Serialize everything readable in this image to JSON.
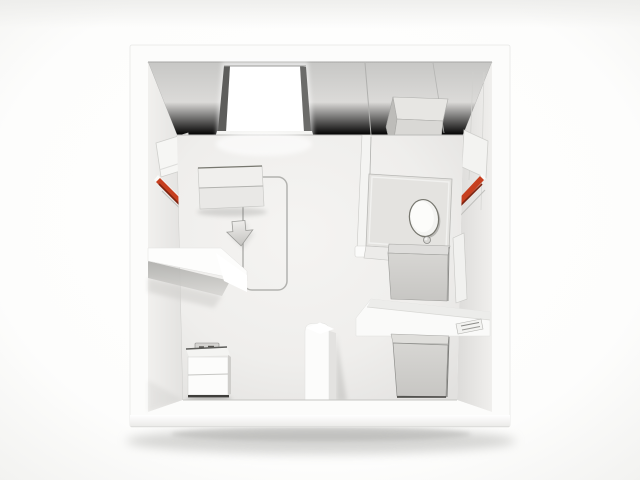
{
  "scene": {
    "type": "3d-architectural-render",
    "view": "top-down cutaway (dollhouse view)",
    "subject": "compact white studio apartment unit with bathroom partition",
    "background_color": "#ffffff"
  },
  "palette": {
    "background": "#ffffff",
    "frame_white": "#fcfcfb",
    "back_wall_top": "#c9c9c7",
    "back_wall_bottom": "#ecebe9",
    "side_wall": "#e7e6e4",
    "floor_light": "#f4f3f1",
    "floor_dark": "#e4e3e1",
    "furniture_white": "#f7f7f5",
    "furniture_gray": "#d2d1ce",
    "window_frame_dark": "#5d5d5b",
    "window_glow": "#ffffff",
    "accent_red": "#c63f1f",
    "accent_red_bright": "#e0582e",
    "accent_red_dark": "#7d2310",
    "outline_gray": "#b2b2af",
    "base_dark": "#3f3e3b",
    "shadow_gray": "#9a9a97"
  },
  "objects": [
    {
      "name": "apartment-shell",
      "label": "white cube shell with thick walls"
    },
    {
      "name": "back-wall",
      "label": "rear wall band with panel seams"
    },
    {
      "name": "window",
      "label": "bright glowing window with dark side frames"
    },
    {
      "name": "upper-cabinet",
      "label": "wall-mounted cabinet box, top right"
    },
    {
      "name": "left-wall-panel",
      "label": "fold-down panel on left wall"
    },
    {
      "name": "left-accent-stripe",
      "label": "diagonal red accent stripe, left wall"
    },
    {
      "name": "right-wall-panel",
      "label": "fold-down panel on right wall"
    },
    {
      "name": "right-accent-stripe",
      "label": "diagonal red accent stripe, right wall"
    },
    {
      "name": "floor",
      "label": "light gray floor with window light pool"
    },
    {
      "name": "bed-footprint-outline",
      "label": "rounded rectangle floor marking"
    },
    {
      "name": "down-arrow-marker",
      "label": "gray arrow marker pointing down"
    },
    {
      "name": "dresser",
      "label": "white two-section sideboard"
    },
    {
      "name": "left-counter",
      "label": "wall counter slab with angled end, left side"
    },
    {
      "name": "nightstand",
      "label": "small white two-drawer cabinet with tray on top"
    },
    {
      "name": "stub-wall",
      "label": "short partition stub from bottom wall"
    },
    {
      "name": "bathroom-partition",
      "label": "thin partition wall from back wall"
    },
    {
      "name": "toilet-platform",
      "label": "square platform in bathroom corner"
    },
    {
      "name": "toilet",
      "label": "oval toilet lid seen from above with flush knob"
    },
    {
      "name": "sink-unit",
      "label": "gray cabinet unit below platform"
    },
    {
      "name": "bathroom-counter",
      "label": "white counter slab spanning to right wall"
    },
    {
      "name": "shower-unit",
      "label": "gray appliance box in lower right compartment"
    },
    {
      "name": "vent-plate",
      "label": "small slotted vent plate on right wall"
    }
  ]
}
